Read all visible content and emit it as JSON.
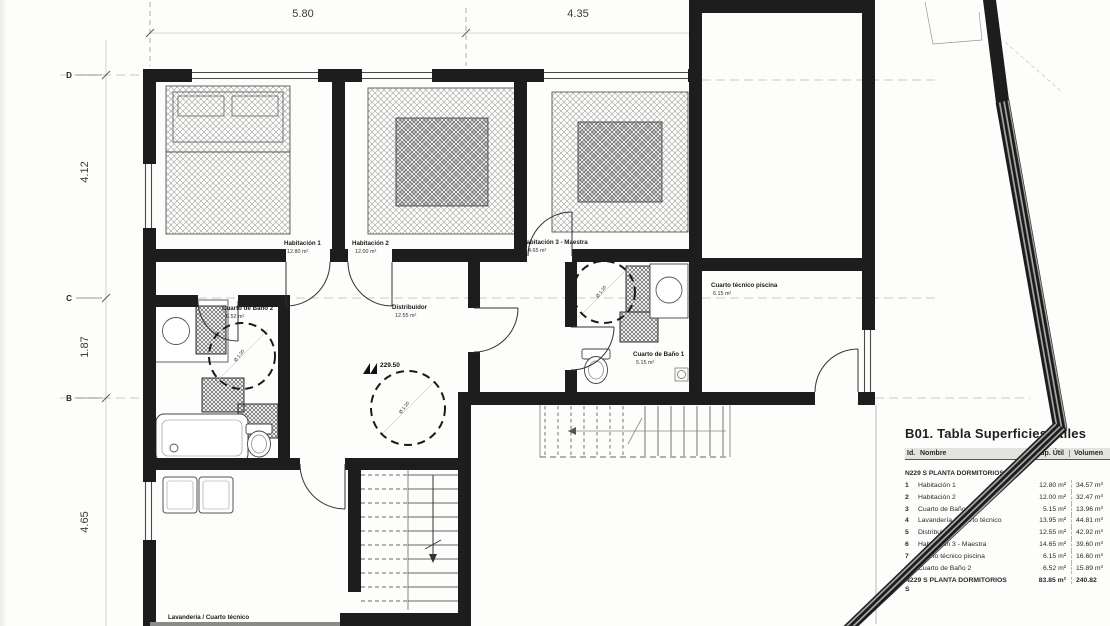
{
  "plan": {
    "dim_top_1": "5.80",
    "dim_top_2": "4.35",
    "dim_left_1": "4.12",
    "dim_left_2": "1.87",
    "dim_left_3": "4.65",
    "grid_d": "D",
    "grid_c": "C",
    "grid_b": "B",
    "level_mark": "229.50",
    "turning_circle_label": "Ø 1.20",
    "rooms": {
      "hab1": {
        "name": "Habitación 1",
        "area": "12.80 m²"
      },
      "hab2": {
        "name": "Habitación 2",
        "area": "12.00 m²"
      },
      "hab3": {
        "name": "Habitación 3 - Maestra",
        "area": "14.65 m²"
      },
      "distribuidor": {
        "name": "Distribuidor",
        "area": "12.55 m²"
      },
      "bano2": {
        "name": "Cuarto de Baño 2",
        "area": "6.52 m²"
      },
      "bano1": {
        "name": "Cuarto de Baño 1",
        "area": "5.15 m²"
      },
      "piscina": {
        "name": "Cuarto técnico piscina",
        "area": "6.15 m²"
      },
      "lavanderia": {
        "name": "Lavandería / Cuarto técnico"
      }
    }
  },
  "table": {
    "title": "B01. Tabla Superficies útiles",
    "columns": {
      "id": "Id.",
      "name": "Nombre",
      "sup": "Sup. Útil",
      "vol": "Volumen"
    },
    "group_header": "N229 S PLANTA DORMITORIOS",
    "rows": [
      {
        "id": "1",
        "name": "Habitación 1",
        "sup": "12.80 m²",
        "vol": "34.57 m³"
      },
      {
        "id": "2",
        "name": "Habitación 2",
        "sup": "12.00 m²",
        "vol": "32.47 m³"
      },
      {
        "id": "3",
        "name": "Cuarto de Baño 1",
        "sup": "5.15 m²",
        "vol": "13.96 m³"
      },
      {
        "id": "4",
        "name": "Lavandería / Cuarto técnico",
        "sup": "13.95 m²",
        "vol": "44.81 m³"
      },
      {
        "id": "5",
        "name": "Distribuidor",
        "sup": "12.55 m²",
        "vol": "42.92 m³"
      },
      {
        "id": "6",
        "name": "Habitación 3 - Maestra",
        "sup": "14.65 m²",
        "vol": "39.60 m³"
      },
      {
        "id": "7",
        "name": "Cuarto técnico piscina",
        "sup": "6.15 m²",
        "vol": "16.60 m³"
      },
      {
        "id": "8",
        "name": "Cuarto de Baño 2",
        "sup": "6.52 m²",
        "vol": "15.89 m³"
      }
    ],
    "total": {
      "name": "N229 S PLANTA DORMITORIOS",
      "sup": "83.85 m²",
      "vol": "240.82"
    },
    "footer": "S"
  },
  "palette": {
    "ink": "#1d1d1d",
    "paper": "#fdfdfc",
    "faint": "#b5b5b6"
  }
}
